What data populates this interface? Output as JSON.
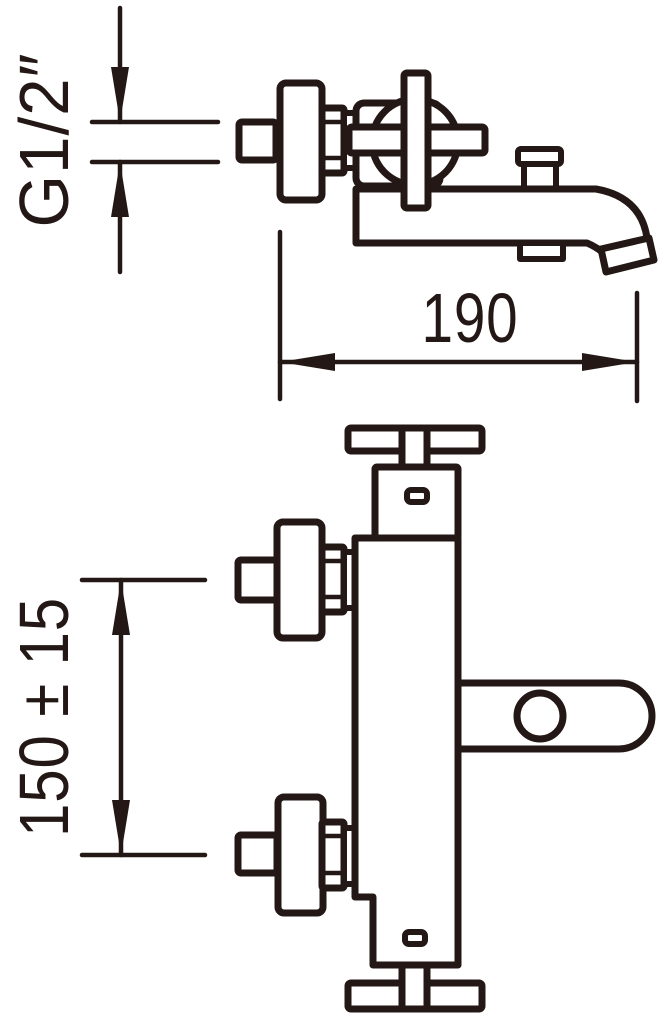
{
  "drawing": {
    "subject": "bath shower mixer tap technical drawing, side view and front view",
    "line_color": "#231815",
    "background_color": "#ffffff",
    "dimensions": {
      "thread_size": "G1/2″",
      "spout_reach": "190",
      "inlet_spacing": "150 ± 15"
    }
  }
}
